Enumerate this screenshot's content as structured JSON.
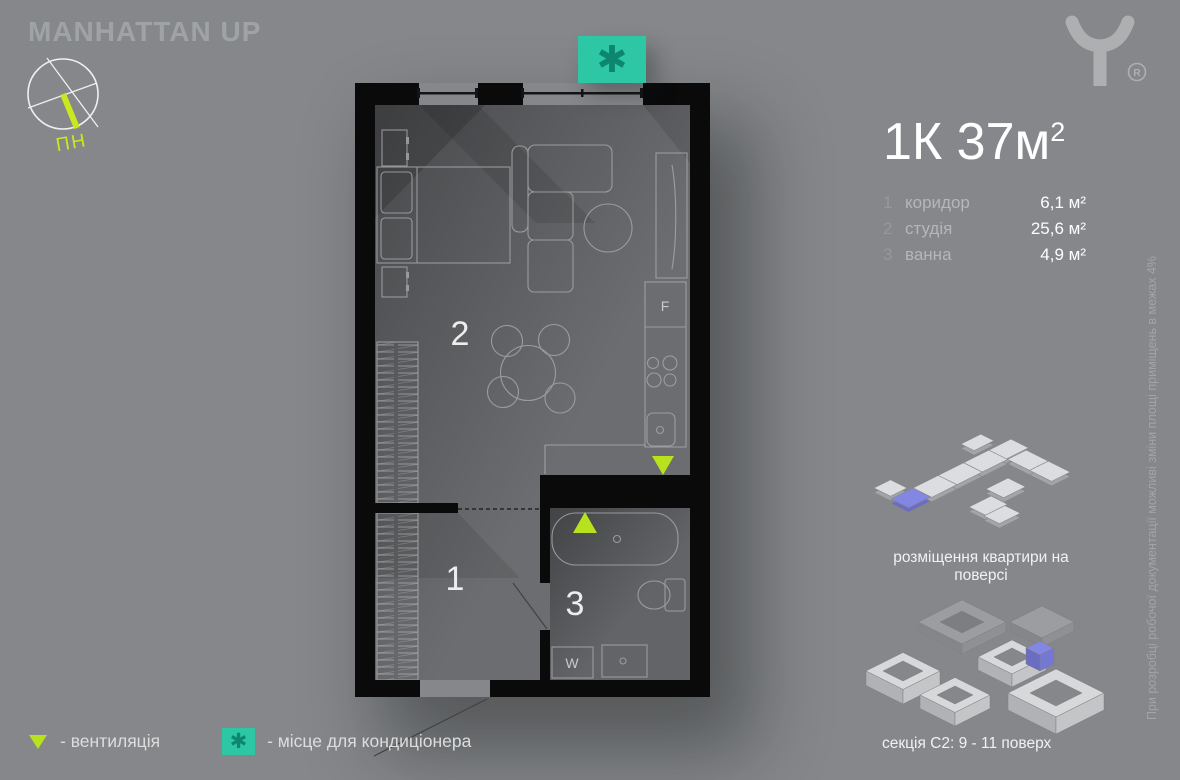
{
  "brand": {
    "name": "MANHATTAN UP",
    "logo_mark": "R"
  },
  "compass": {
    "label": "ПН"
  },
  "title": {
    "main": "1К 37м",
    "sup": "2"
  },
  "rooms": [
    {
      "num": "1",
      "name": "коридор",
      "area": "6,1 м²"
    },
    {
      "num": "2",
      "name": "студія",
      "area": "25,6 м²"
    },
    {
      "num": "3",
      "name": "ванна",
      "area": "4,9 м²"
    }
  ],
  "plan": {
    "labels": {
      "corridor": "1",
      "studio": "2",
      "bath": "3",
      "fridge": "F",
      "washer": "W"
    }
  },
  "legend": {
    "vent_label": "- вентиляція",
    "ac_label": "- місце для кондиціонера",
    "ac_symbol": "✱"
  },
  "diagrams": {
    "floor_caption": "розміщення квартири на поверсі",
    "section_caption": "секція С2: 9 - 11 поверх"
  },
  "disclaimer": "При розробці робочої документації можливі зміни площі приміщень в межах 4%",
  "colors": {
    "accent_green": "#b9e21e",
    "teal": "#2dc7a6",
    "highlight_purple": "#8386e2"
  }
}
